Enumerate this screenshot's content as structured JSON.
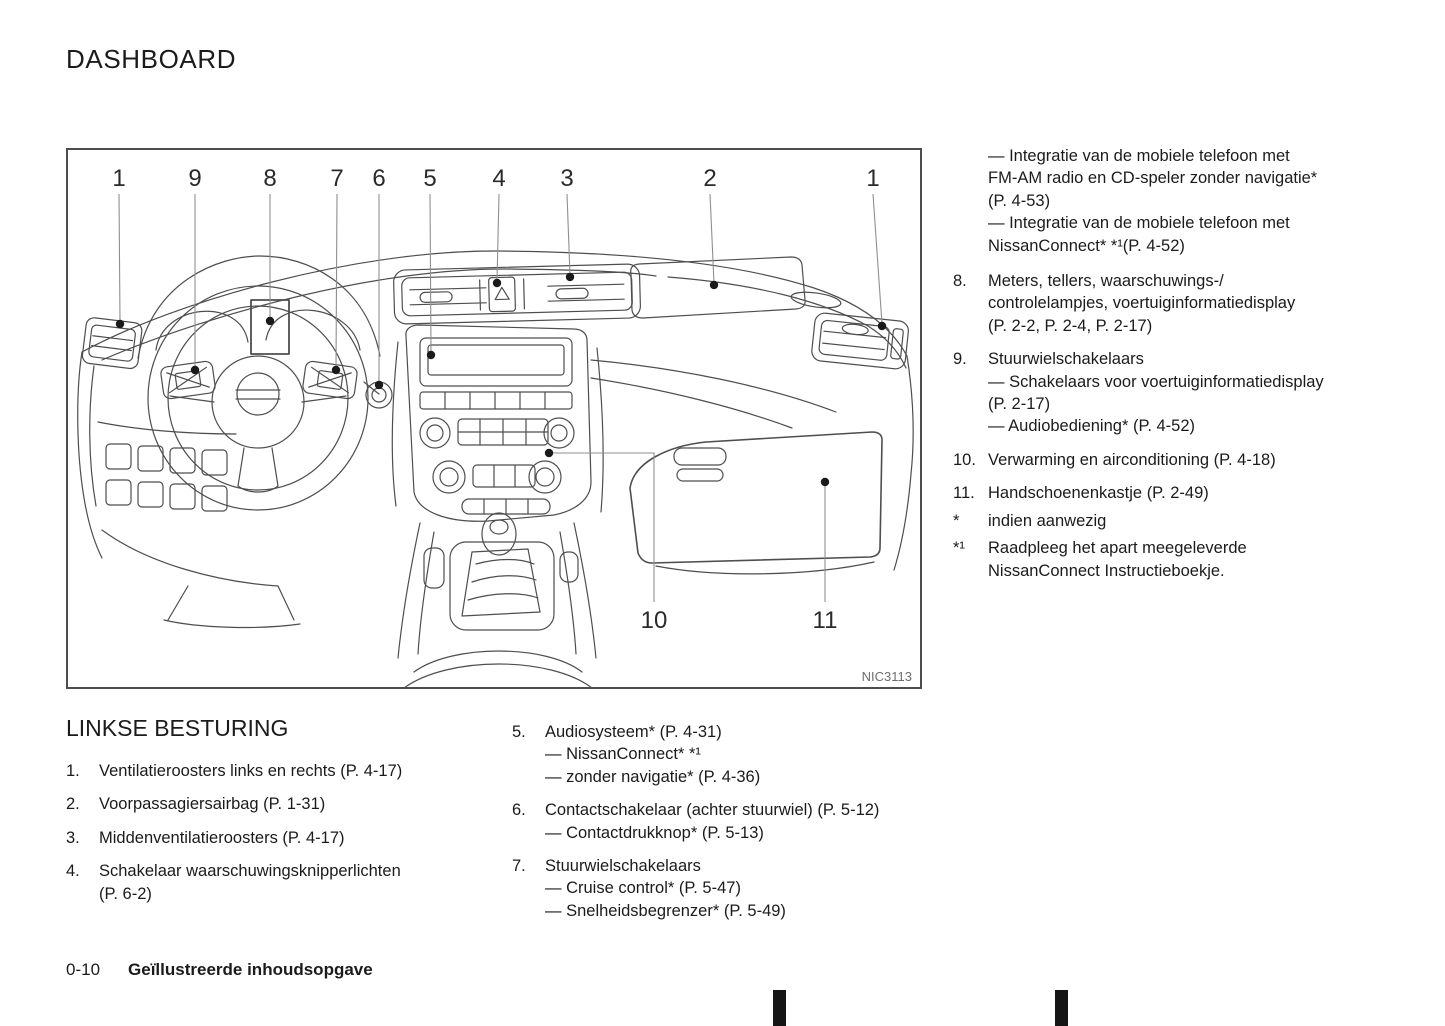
{
  "page": {
    "title": "DASHBOARD",
    "footer": {
      "page_number": "0-10",
      "section_title": "Geïllustreerde inhoudsopgave"
    }
  },
  "colors": {
    "text": "#1b1b1b",
    "line_art": "#4e4e4e",
    "leader_line": "#8f8f8f",
    "figure_code": "#6e6e6e",
    "print_mark": "#151515"
  },
  "figure": {
    "code": "NIC3113",
    "callouts": [
      "1",
      "9",
      "8",
      "7",
      "6",
      "5",
      "4",
      "3",
      "2",
      "1",
      "10",
      "11"
    ]
  },
  "right_column": {
    "continuation_lines": [
      "— Integratie van de mobiele telefoon met",
      "FM-AM radio en CD-speler zonder navigatie*",
      "(P. 4-53)",
      "— Integratie van de mobiele telefoon met",
      "NissanConnect* *¹(P. 4-52)"
    ],
    "items": [
      {
        "num": "8.",
        "lines": [
          "Meters, tellers, waarschuwings-/",
          "controlelampjes, voertuiginformatiedisplay",
          "(P. 2-2, P. 2-4, P. 2-17)"
        ]
      },
      {
        "num": "9.",
        "lines": [
          "Stuurwielschakelaars",
          "— Schakelaars voor voertuiginformatiedisplay",
          "(P. 2-17)",
          "— Audiobediening* (P. 4-52)"
        ]
      },
      {
        "num": "10.",
        "lines": [
          "Verwarming en airconditioning (P. 4-18)"
        ]
      },
      {
        "num": "11.",
        "lines": [
          "Handschoenenkastje (P. 2-49)"
        ]
      },
      {
        "num": "*",
        "lines": [
          "indien aanwezig"
        ]
      },
      {
        "num": "*¹",
        "lines": [
          "Raadpleeg het apart meegeleverde",
          "NissanConnect Instructieboekje."
        ]
      }
    ]
  },
  "left_section": {
    "heading": "LINKSE BESTURING",
    "items": [
      {
        "num": "1.",
        "lines": [
          "Ventilatieroosters links en rechts (P. 4-17)"
        ]
      },
      {
        "num": "2.",
        "lines": [
          "Voorpassagiersairbag (P. 1-31)"
        ]
      },
      {
        "num": "3.",
        "lines": [
          "Middenventilatieroosters (P. 4-17)"
        ]
      },
      {
        "num": "4.",
        "lines": [
          "Schakelaar waarschuwingsknipperlichten",
          "(P. 6-2)"
        ]
      }
    ]
  },
  "mid_section": {
    "items": [
      {
        "num": "5.",
        "lines": [
          "Audiosysteem* (P. 4-31)",
          "— NissanConnect* *¹",
          "— zonder navigatie* (P. 4-36)"
        ]
      },
      {
        "num": "6.",
        "lines": [
          "Contactschakelaar (achter stuurwiel) (P. 5-12)",
          "— Contactdrukknop* (P. 5-13)"
        ]
      },
      {
        "num": "7.",
        "lines": [
          "Stuurwielschakelaars",
          "— Cruise control* (P. 5-47)",
          "— Snelheidsbegrenzer* (P. 5-49)"
        ]
      }
    ]
  }
}
